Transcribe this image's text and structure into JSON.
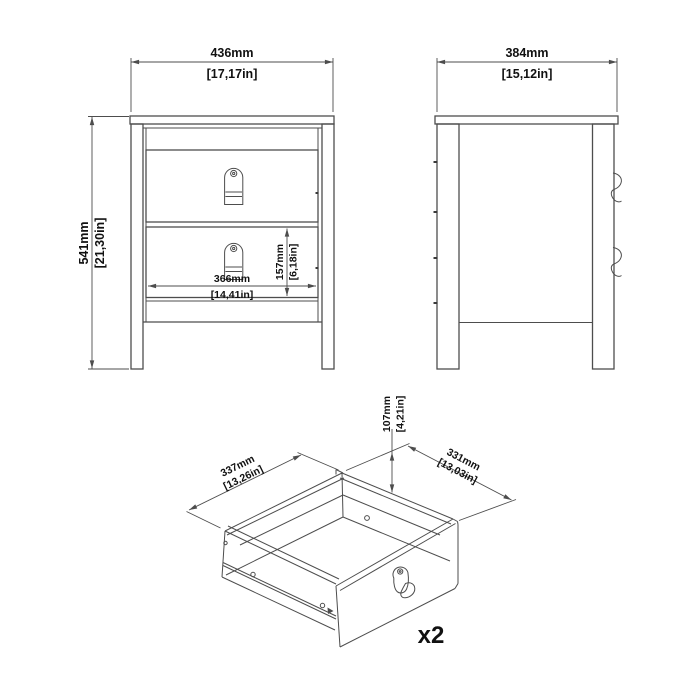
{
  "colors": {
    "background": "#ffffff",
    "line": "#4d4d4d",
    "text": "#111111"
  },
  "front_view": {
    "width_dim": {
      "mm": "436mm",
      "in": "[17,17in]"
    },
    "height_dim": {
      "mm": "541mm",
      "in": "[21,30in]"
    },
    "drawer_width_dim": {
      "mm": "366mm",
      "in": "[14,41in]"
    },
    "drawer_height_dim": {
      "mm": "157mm",
      "in": "[6,18in]"
    }
  },
  "side_view": {
    "depth_dim": {
      "mm": "384mm",
      "in": "[15,12in]"
    }
  },
  "drawer_view": {
    "width_dim": {
      "mm": "337mm",
      "in": "[13,26in]"
    },
    "depth_dim": {
      "mm": "331mm",
      "in": "[13,03in]"
    },
    "height_dim": {
      "mm": "107mm",
      "in": "[4,21in]"
    },
    "quantity_label": "x2"
  }
}
